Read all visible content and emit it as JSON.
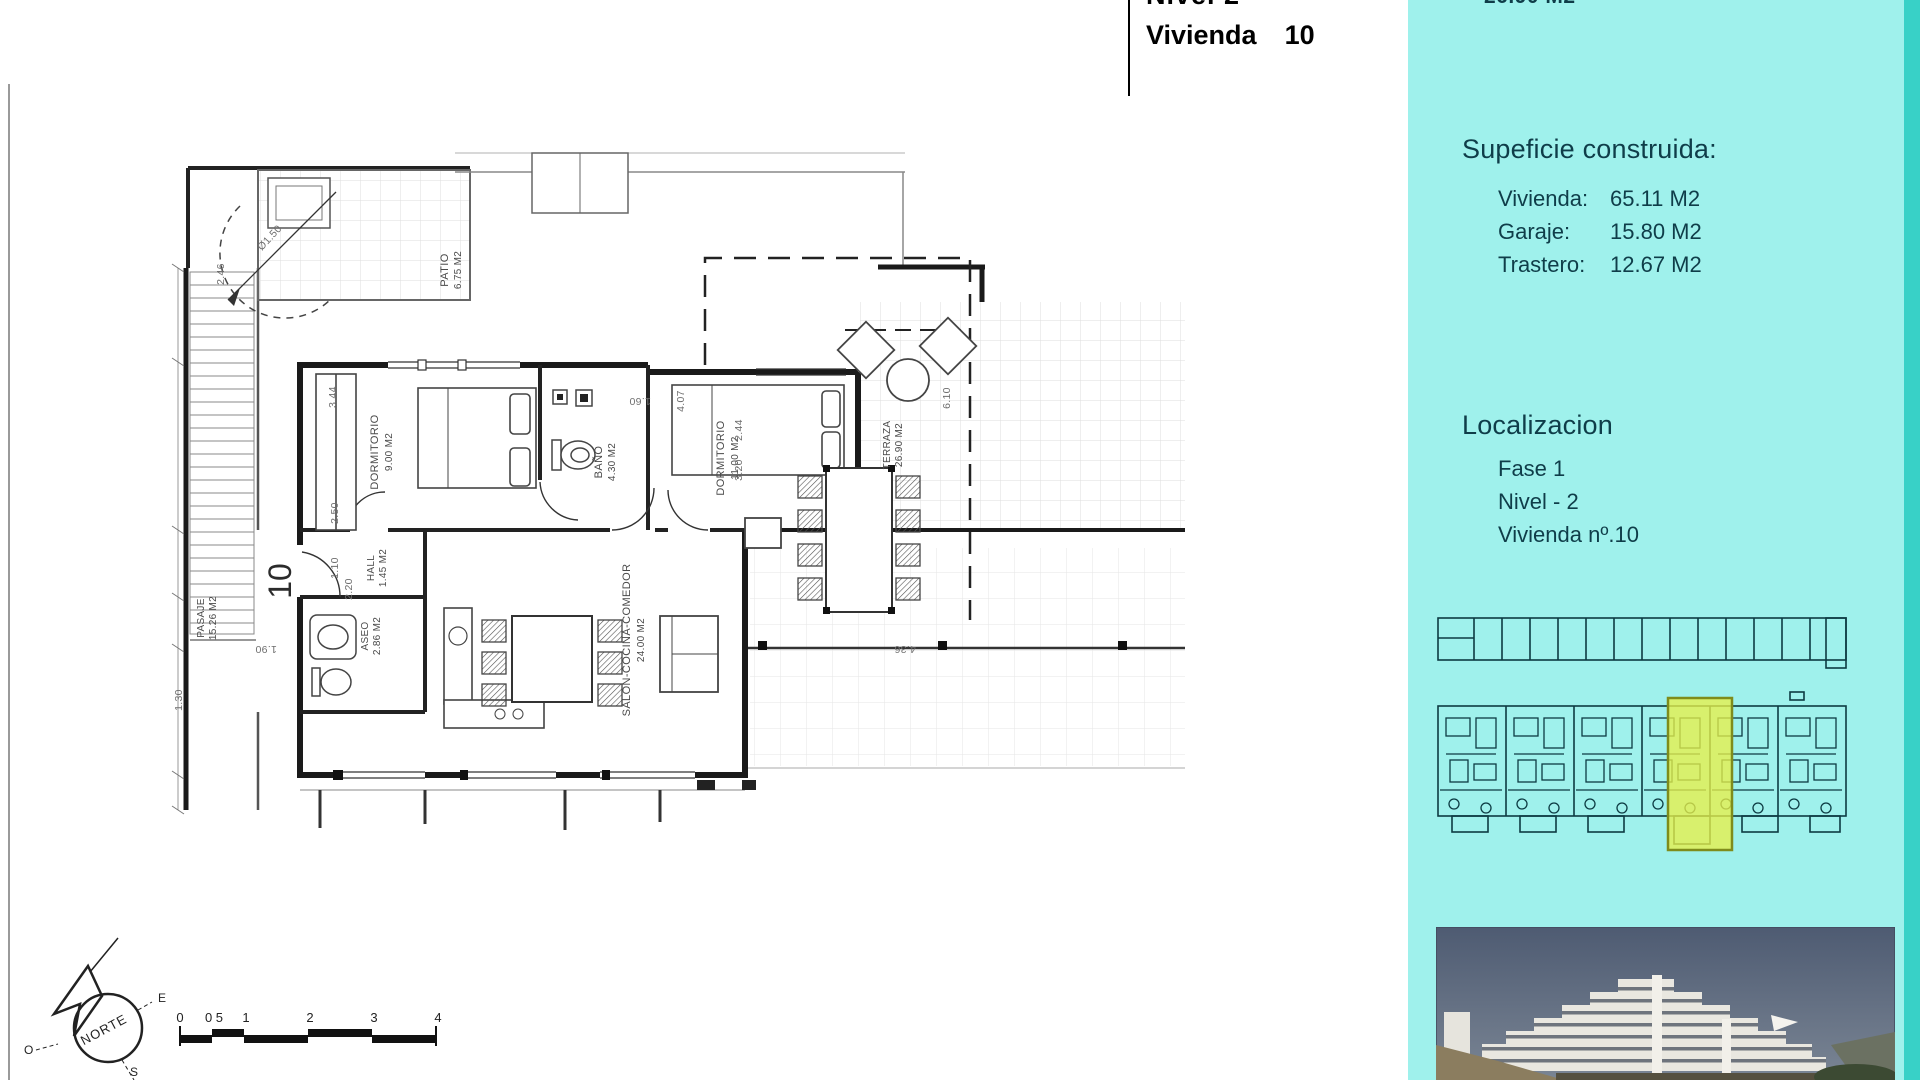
{
  "title_block": {
    "line1": "Nivel 2",
    "line2_label": "Vivienda",
    "line2_number": "10"
  },
  "sidebar": {
    "background_color": "#9ff1ec",
    "edge_color": "#38d1c7",
    "text_color": "#0f3d49",
    "top_partial_value": "26.90 M2",
    "surface": {
      "heading": "Supeficie construida:",
      "items": [
        {
          "label": "Vivienda:",
          "value": "65.11 M2"
        },
        {
          "label": "Garaje:",
          "value": "15.80 M2"
        },
        {
          "label": "Trastero:",
          "value": "12.67 M2"
        }
      ]
    },
    "location": {
      "heading": "Localizacion",
      "items": [
        "Fase 1",
        "Nivel - 2",
        "Vivienda nº.10"
      ]
    },
    "siteplan": {
      "highlight_color": "#e8ef49"
    },
    "photo": {
      "alt": "apartment buildings on hillside"
    }
  },
  "floorplan": {
    "unit_number": "10",
    "rooms": {
      "patio": {
        "name": "PATIO",
        "area": "6.75 M2"
      },
      "dorm1": {
        "name": "DORMITORIO",
        "area": "9.00 M2"
      },
      "bano": {
        "name": "BAÑO",
        "area": "4.30 M2"
      },
      "dorm2": {
        "name": "DORMITORIO",
        "area": "11.00 M2"
      },
      "salon": {
        "name": "SALON-COCINA-COMEDOR",
        "area": "24.00 M2"
      },
      "aseo": {
        "name": "ASEO",
        "area": "2.86 M2"
      },
      "hall": {
        "name": "HALL",
        "area": "1.45 M2"
      },
      "pasaje": {
        "name": "PASAJE",
        "area": "15.26 M2"
      },
      "terraza": {
        "name": "TERRAZA",
        "area": "26.90 M2"
      }
    },
    "dimensions": [
      "2.46",
      "3.44",
      "2.50",
      "1.10",
      "1.60",
      "4.07",
      "6.10",
      "2.44",
      "3.20",
      "2.20",
      "1.90",
      "1.30",
      "4.36",
      "Ø1.50"
    ],
    "compass": {
      "north": "NORTE",
      "east": "E",
      "west": "O",
      "south": "S"
    },
    "scalebar": {
      "labels": [
        "0",
        "0 5",
        "1",
        "2",
        "3",
        "4"
      ]
    }
  }
}
